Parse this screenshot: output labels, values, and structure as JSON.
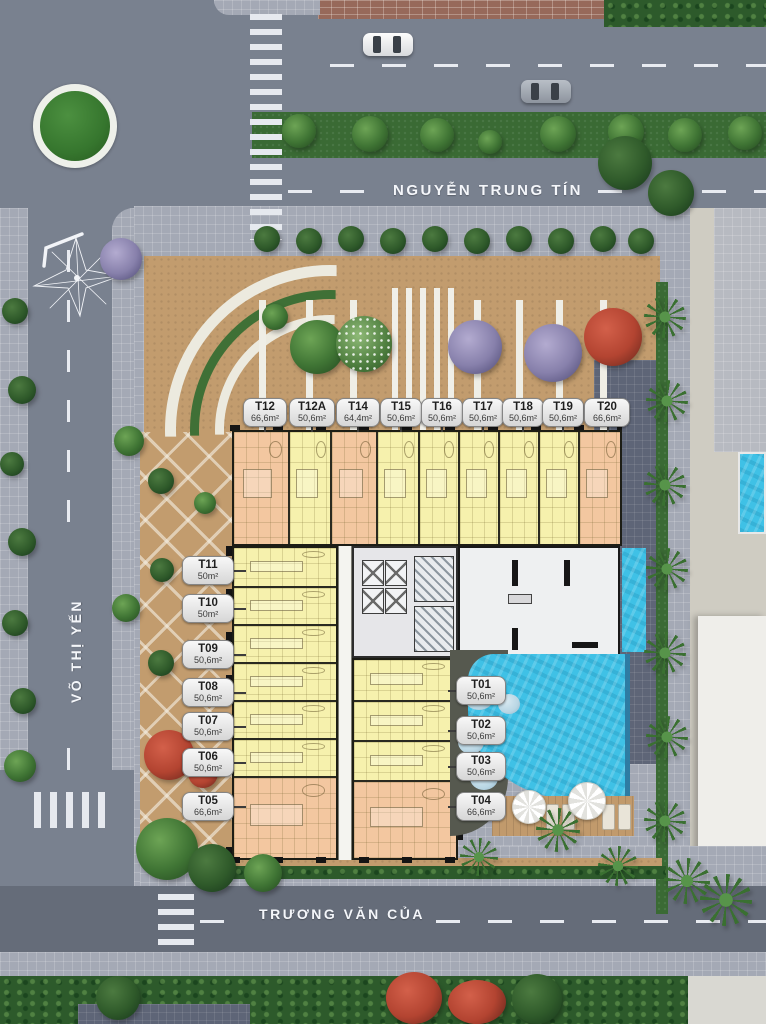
{
  "page": {
    "type": "residential-site-plan"
  },
  "streets": {
    "top": "NGUYỄN TRUNG TÍN",
    "left": "VÕ THỊ YẾN",
    "bottom": "TRƯƠNG VĂN CỦA"
  },
  "units": {
    "top_row": [
      {
        "id": "T12",
        "area": "66,6m²"
      },
      {
        "id": "T12A",
        "area": "50,6m²"
      },
      {
        "id": "T14",
        "area": "64,4m²"
      },
      {
        "id": "T15",
        "area": "50,6m²"
      },
      {
        "id": "T16",
        "area": "50,6m²"
      },
      {
        "id": "T17",
        "area": "50,6m²"
      },
      {
        "id": "T18",
        "area": "50,6m²"
      },
      {
        "id": "T19",
        "area": "50,6m²"
      },
      {
        "id": "T20",
        "area": "66,6m²"
      }
    ],
    "left_column": [
      {
        "id": "T11",
        "area": "50m²"
      },
      {
        "id": "T10",
        "area": "50m²"
      },
      {
        "id": "T09",
        "area": "50,6m²"
      },
      {
        "id": "T08",
        "area": "50,6m²"
      },
      {
        "id": "T07",
        "area": "50,6m²"
      },
      {
        "id": "T06",
        "area": "50,6m²"
      },
      {
        "id": "T05",
        "area": "66,6m²"
      }
    ],
    "right_column": [
      {
        "id": "T01",
        "area": "50,6m²"
      },
      {
        "id": "T02",
        "area": "50,6m²"
      },
      {
        "id": "T03",
        "area": "50,6m²"
      },
      {
        "id": "T04",
        "area": "66,6m²"
      }
    ]
  },
  "colors": {
    "unit_yellow": "#f6f1ad",
    "unit_peach": "#f3c7a0",
    "pool_blue": "#3fc1e6",
    "road_asphalt": "#79818f",
    "landscape_tan": "#c29c6e",
    "grass_green": "#3a6a34",
    "callout_bg": "#ededed"
  },
  "icons": {
    "compass": "compass-rose"
  }
}
